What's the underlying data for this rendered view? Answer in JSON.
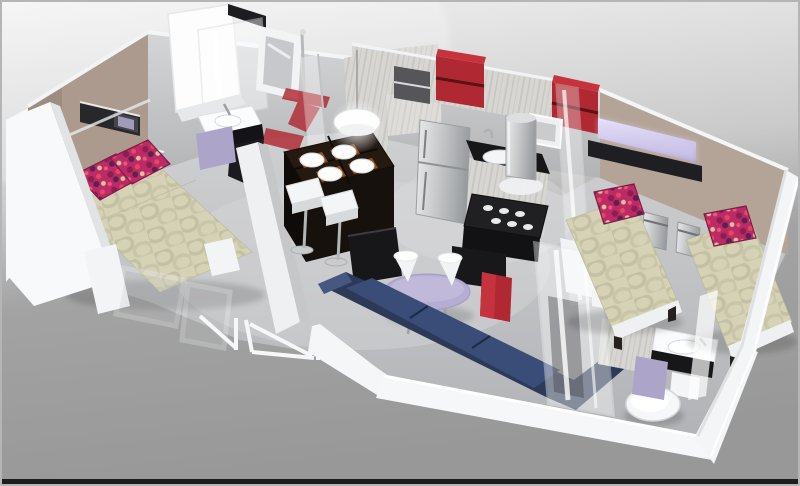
{
  "scene": {
    "type": "3d-isometric-floor-plan-render",
    "description": "Cutaway 3D rendering of a small apartment / mobile-home floor plan viewed from above",
    "rooms": [
      {
        "name": "master-bedroom",
        "position": "left",
        "furniture": [
          "double-bed-with-patterned-duvet",
          "two-magenta-pillows",
          "plank-headboard",
          "wall-storage-unit",
          "lavender-accent-light"
        ]
      },
      {
        "name": "bathroom",
        "position": "top-left",
        "furniture": [
          "shower-cabin",
          "wall-window",
          "towel-rail",
          "vanity-sink",
          "red-wall-decal"
        ]
      },
      {
        "name": "kitchen",
        "position": "top-center",
        "furniture": [
          "upper-cabinets",
          "two-red-shelf-units",
          "fridge",
          "sink-with-faucet",
          "water-heater-cylinder",
          "gas-cooktop",
          "window"
        ]
      },
      {
        "name": "dining",
        "position": "center",
        "furniture": [
          "high-bar-table",
          "four-plates-on-placemats",
          "two-bar-stools",
          "pendant-dome-lamp"
        ]
      },
      {
        "name": "living-room",
        "position": "center-bottom",
        "furniture": [
          "navy-corner-sofa",
          "lavender-oval-table",
          "two-white-cone-stools",
          "tv-cabinet",
          "red-cabinet"
        ]
      },
      {
        "name": "shower-room",
        "position": "bottom-right",
        "furniture": [
          "glass-shower-enclosure",
          "toilet",
          "vanity-sink"
        ]
      },
      {
        "name": "twin-bedroom",
        "position": "right",
        "furniture": [
          "single-bed-1",
          "single-bed-2",
          "two-nightstands",
          "black-wall-shelf",
          "lavender-accent-light"
        ]
      }
    ]
  },
  "palette": {
    "background_top": "#f3f3f3",
    "background_bottom": "#989898",
    "frame_border": "#1d1d1d",
    "floor_mid": "#c3c4c6",
    "floor_light": "#d6d7d8",
    "wall_white": "#f6f7f9",
    "wall_gray": "#c0c1c4",
    "taupe_wall": "#ab9a8d",
    "taupe_wall_right": "#b4a497",
    "sofa_navy": "#2c3a57",
    "sofa_seat": "#3a4c78",
    "table_lavender": "#b6add3",
    "furniture_lavender": "#aca4c9",
    "glow_lavender": "#d9d2f2",
    "accent_red": "#b02832",
    "accent_red_bright": "#c5333e",
    "duvet_beige": "#d5d2b6",
    "duvet_pattern": "#c3c0a3",
    "pillow_magenta": "#bd2a66",
    "wood_dark": "#241a12",
    "black_furniture": "#17171a",
    "steel_light": "#e9eaec",
    "steel_dark": "#9da0a3",
    "chrome": "#b3b6b9",
    "placemat_orange": "#a8561c",
    "white_fixture": "#fafbfc"
  }
}
